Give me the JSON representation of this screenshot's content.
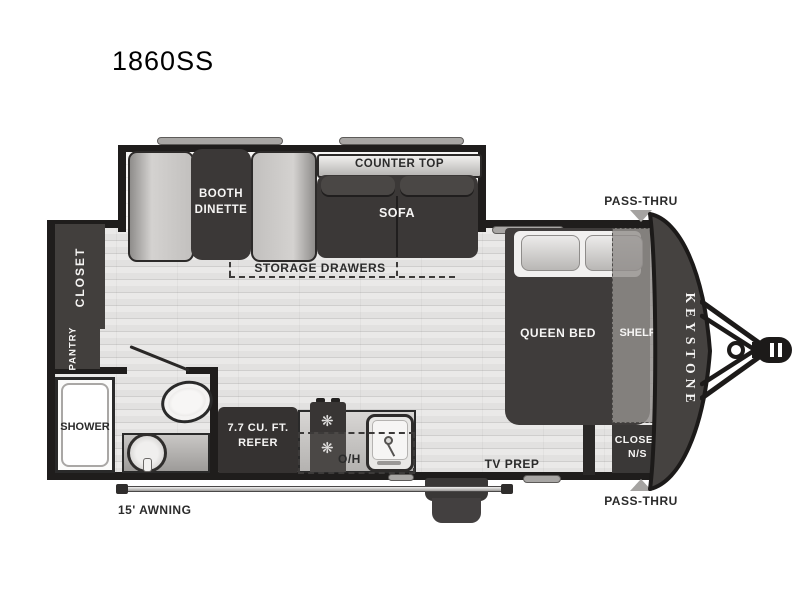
{
  "title": "1860SS",
  "brand": "KEYSTONE",
  "colors": {
    "wall": "#1f1d1c",
    "dark_furniture": "#3b3837",
    "counter_gray": "#c9c7c5",
    "floor_gray": "#e7e6e5",
    "marker_gray": "#a5a3a1"
  },
  "labels": {
    "booth_dinette_line1": "BOOTH",
    "booth_dinette_line2": "DINETTE",
    "counter_top": "COUNTER TOP",
    "sofa": "SOFA",
    "storage_drawers": "STORAGE DRAWERS",
    "closet": "CLOSET",
    "pantry": "PANTRY",
    "shower": "SHOWER",
    "refer_line1": "7.7 CU. FT.",
    "refer_line2": "REFER",
    "overhead": "O/H",
    "queen_bed": "QUEEN BED",
    "shelf": "SHELF",
    "closet_ns_line1": "CLOSET",
    "closet_ns_line2": "N/S",
    "tv_prep": "TV PREP",
    "pass_thru_top": "PASS-THRU",
    "pass_thru_bottom": "PASS-THRU",
    "awning": "15' AWNING"
  },
  "icons": {
    "burner": "❋"
  }
}
